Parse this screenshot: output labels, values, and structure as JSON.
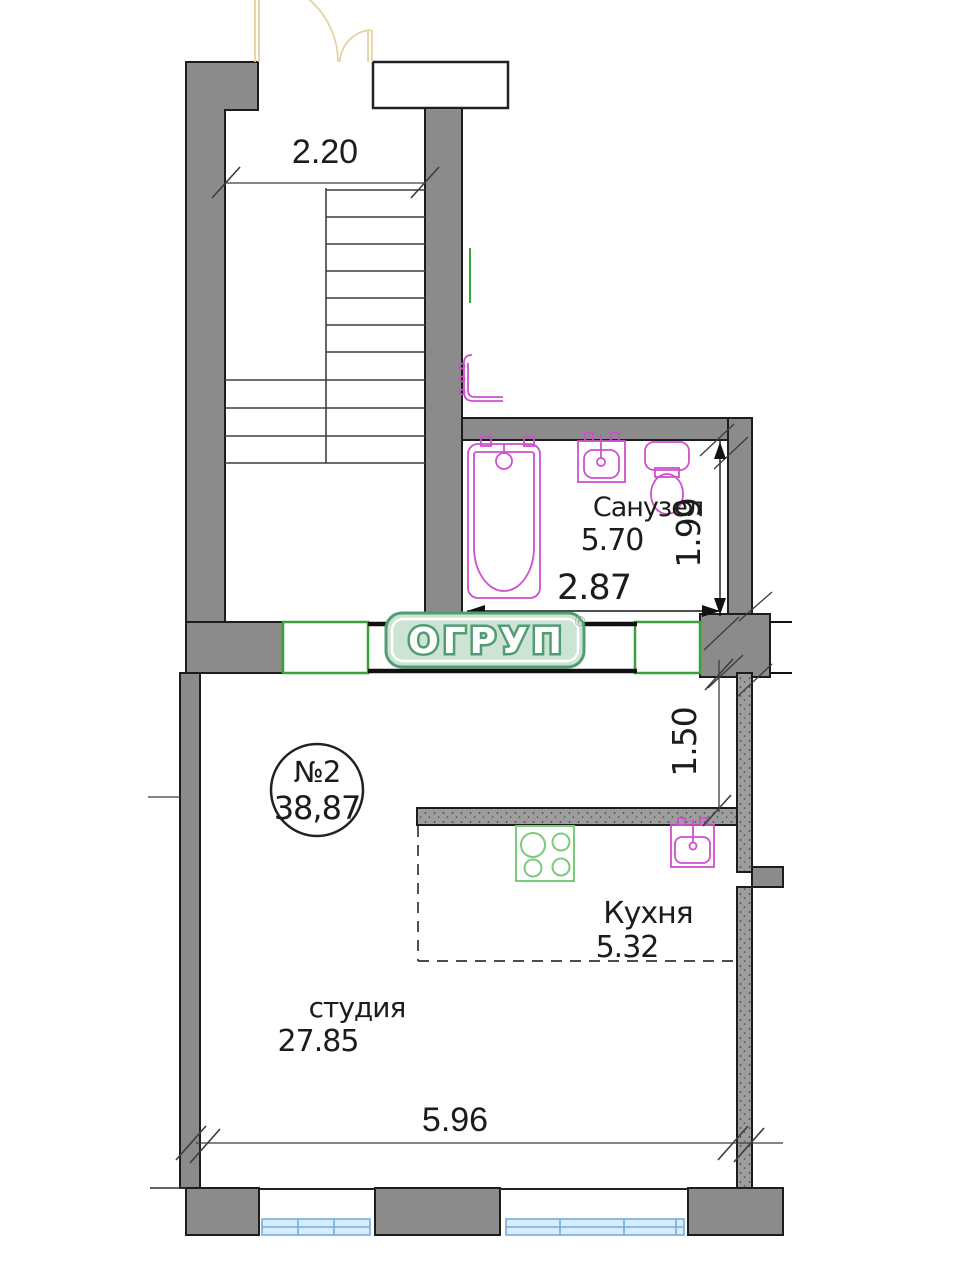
{
  "unit": {
    "number": "№2",
    "area": "38,87"
  },
  "rooms": {
    "bathroom": {
      "name": "Санузел",
      "area": "5.70"
    },
    "kitchen": {
      "name": "Кухня",
      "area": "5.32"
    },
    "studio": {
      "name": "студия",
      "area": "27.85"
    }
  },
  "dimensions": {
    "top_width": "2.20",
    "bathroom_width": "2.87",
    "bathroom_depth": "1.99",
    "kitchen_depth": "1.50",
    "studio_width": "5.96"
  },
  "logo": {
    "text": "ОГРУП",
    "reg": "®"
  },
  "colors": {
    "wall_gray": "#8b8b8b",
    "fixture_magenta": "#cf4fcf",
    "fixture_green": "#7ccb7c",
    "window_green": "#3aa23a",
    "window_blue": "#74aede",
    "logo_green": "#4f9e72",
    "door_tan": "#e6d2a0"
  }
}
